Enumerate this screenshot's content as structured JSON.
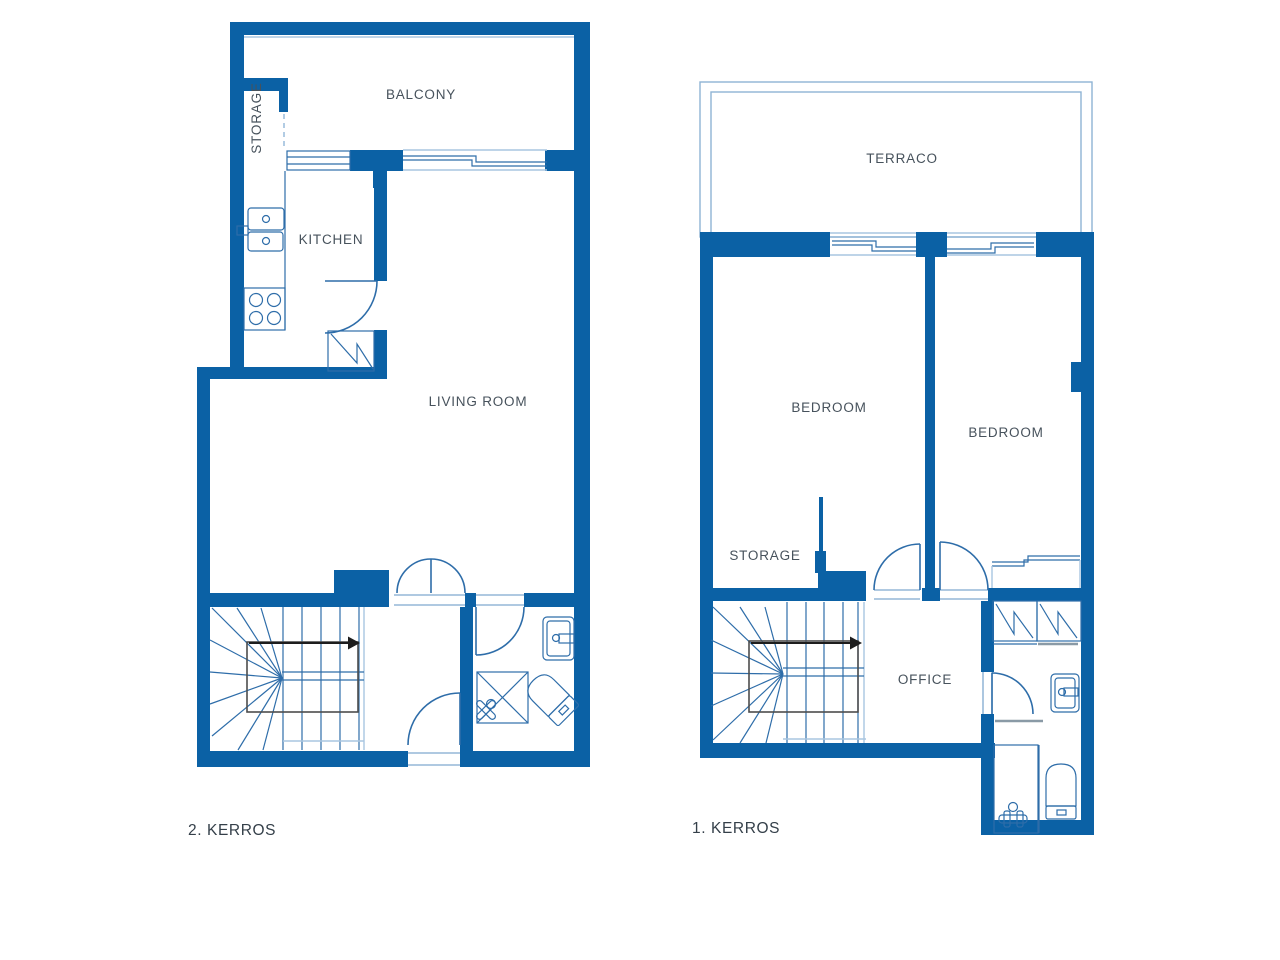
{
  "title": "Two-storey apartment floor plan",
  "colors": {
    "wall_blue": "#0b61a5",
    "fixture_line": "#2e6da9",
    "light_line": "#a9c6e0",
    "terrace_line": "#8fb3d4",
    "stair_box_gray": "#4d4d4d",
    "arrow_black": "#1d1d1d",
    "label_text": "#47525c",
    "floor_label_text": "#343f49",
    "background": "#ffffff"
  },
  "floor2": {
    "caption": "2. KERROS",
    "rooms": {
      "balcony": "BALCONY",
      "storage": "STORAGE",
      "kitchen": "KITCHEN",
      "living_room": "LIVING ROOM"
    }
  },
  "floor1": {
    "caption": "1. KERROS",
    "rooms": {
      "terrace": "TERRACO",
      "bedroom_left": "BEDROOM",
      "bedroom_right": "BEDROOM",
      "storage": "STORAGE",
      "office": "OFFICE"
    }
  }
}
